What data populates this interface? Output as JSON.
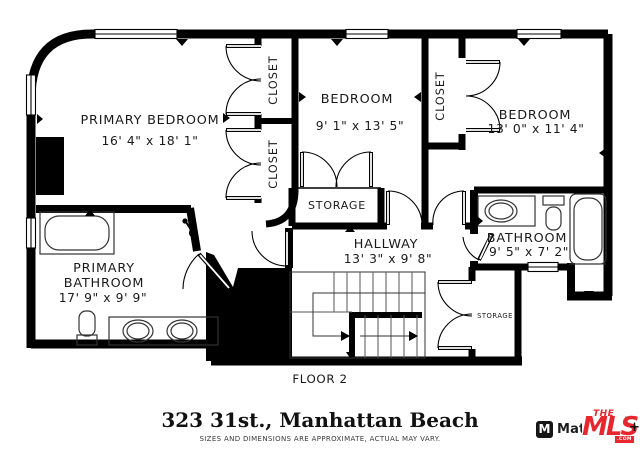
{
  "plan": {
    "floor_label": "FLOOR 2",
    "rooms": {
      "primary_bedroom": {
        "name": "PRIMARY BEDROOM",
        "dims": "16' 4\" x 18' 1\""
      },
      "bedroom_mid": {
        "name": "BEDROOM",
        "dims": "9' 1\" x 13' 5\""
      },
      "bedroom_right": {
        "name": "BEDROOM",
        "dims": "13' 0\" x 11' 4\""
      },
      "hallway": {
        "name": "HALLWAY",
        "dims": "13' 3\" x 9' 8\""
      },
      "primary_bathroom": {
        "name_line1": "PRIMARY",
        "name_line2": "BATHROOM",
        "dims": "17' 9\" x 9' 9\""
      },
      "bathroom": {
        "name": "BATHROOM",
        "dims": "9' 5\" x 7' 2\""
      },
      "closet_top": {
        "name": "CLOSET"
      },
      "closet_mid": {
        "name": "CLOSET"
      },
      "closet_right": {
        "name": "CLOSET"
      },
      "storage_mid": {
        "name": "STORAGE"
      },
      "storage_right": {
        "name": "STORAGE"
      }
    }
  },
  "footer": {
    "address": "323 31st., Manhattan Beach",
    "disclaimer": "SIZES AND DIMENSIONS ARE APPROXIMATE, ACTUAL MAY VARY.",
    "logos": {
      "matterport_text": "Matterport",
      "matterport_icon_glyph": "M",
      "mls_the": "THE",
      "mls_main": "MLS",
      "mls_tm": "™",
      "mls_com": ".COM",
      "mls_plus": "+"
    }
  },
  "colors": {
    "wall": "#000000",
    "accent_red": "#e8262d",
    "text": "#1a1a1a"
  }
}
